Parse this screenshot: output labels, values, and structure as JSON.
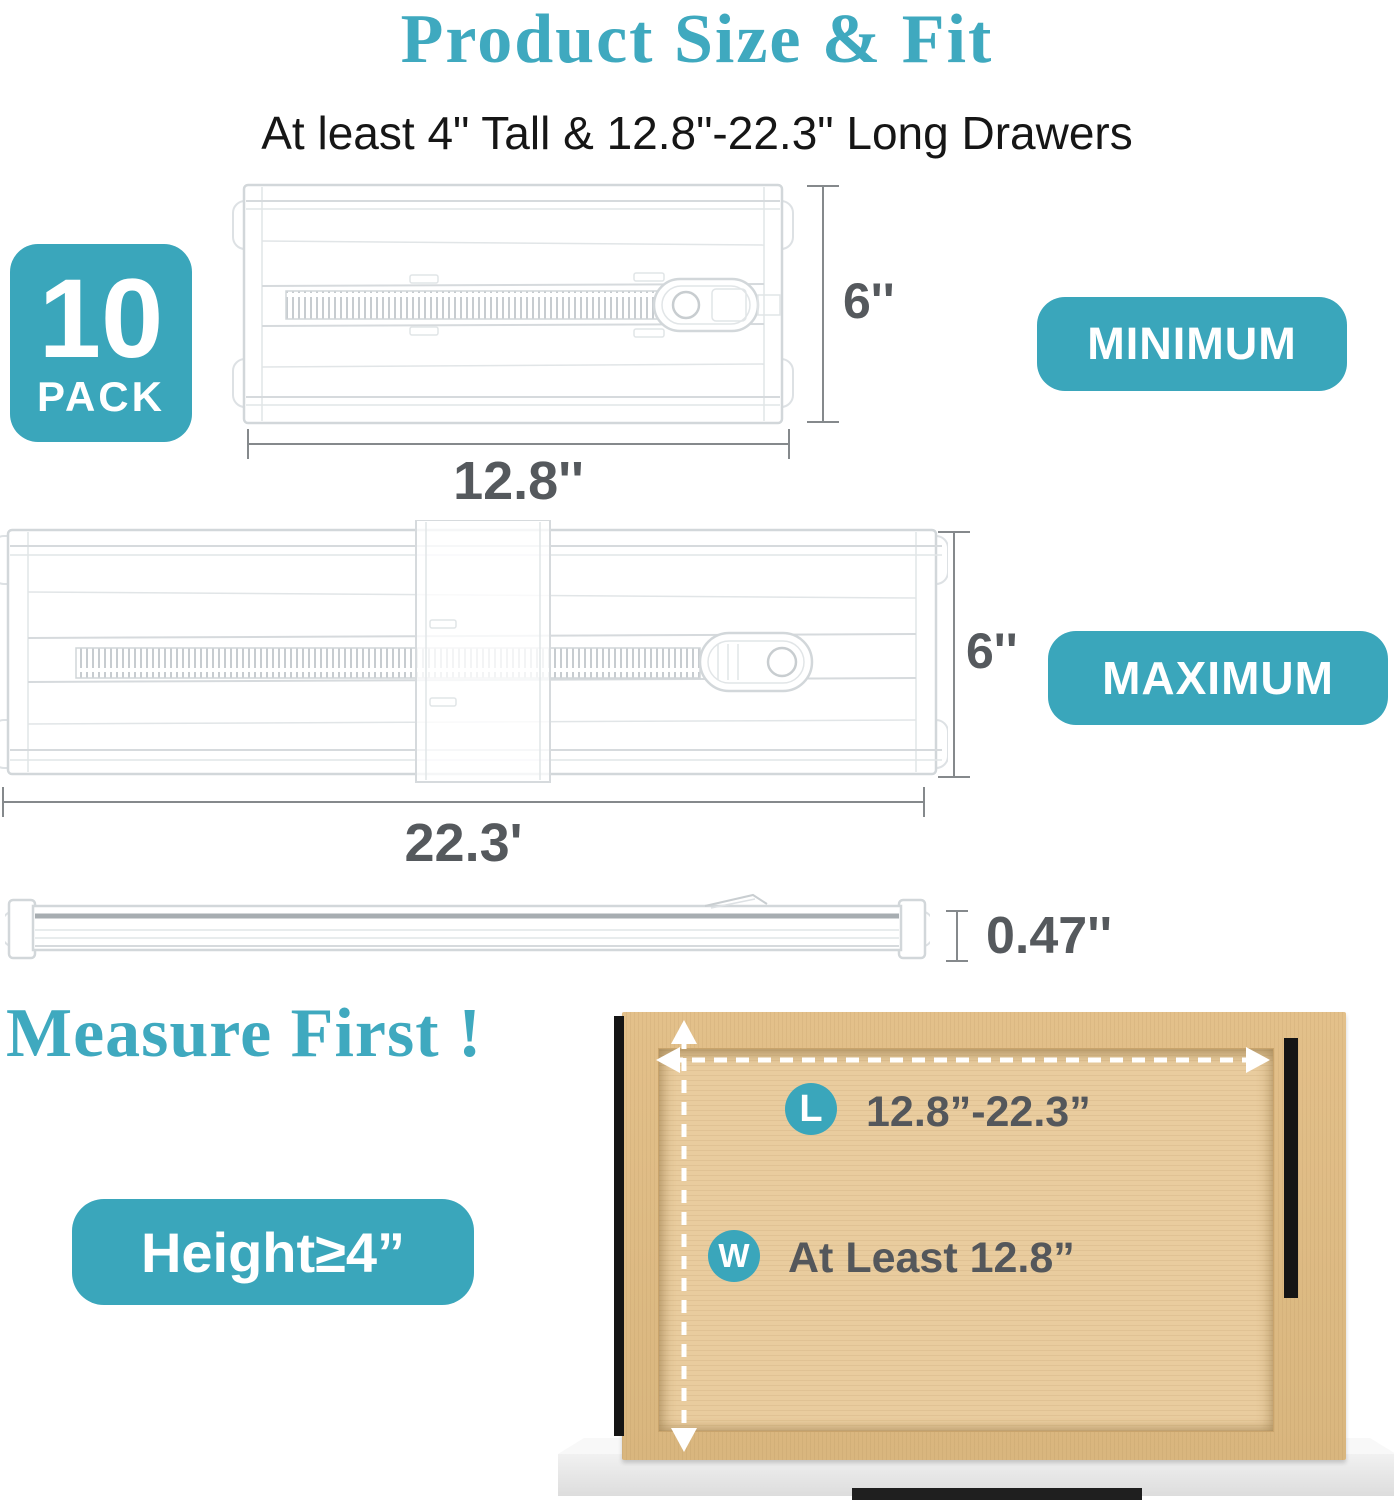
{
  "title": "Product Size & Fit",
  "subtitle": "At least 4\" Tall & 12.8\"-22.3\" Long Drawers",
  "pack_badge": {
    "count": "10",
    "unit": "PACK"
  },
  "min_divider": {
    "tag": "MINIMUM",
    "height": "6''",
    "length": "12.8''"
  },
  "max_divider": {
    "tag": "MAXIMUM",
    "height": "6''",
    "length": "22.3'"
  },
  "side_view": {
    "thickness": "0.47''"
  },
  "measure_section": {
    "heading": "Measure First !",
    "height_badge": "Height≥4”",
    "length_marker": "L",
    "length_value": "12.8”-22.3”",
    "width_marker": "W",
    "width_value": "At Least 12.8”"
  },
  "colors": {
    "accent_teal": "#3AA6BB",
    "dim_text": "#55595d",
    "dim_line": "#85898c",
    "wood": "#e3c08a"
  }
}
